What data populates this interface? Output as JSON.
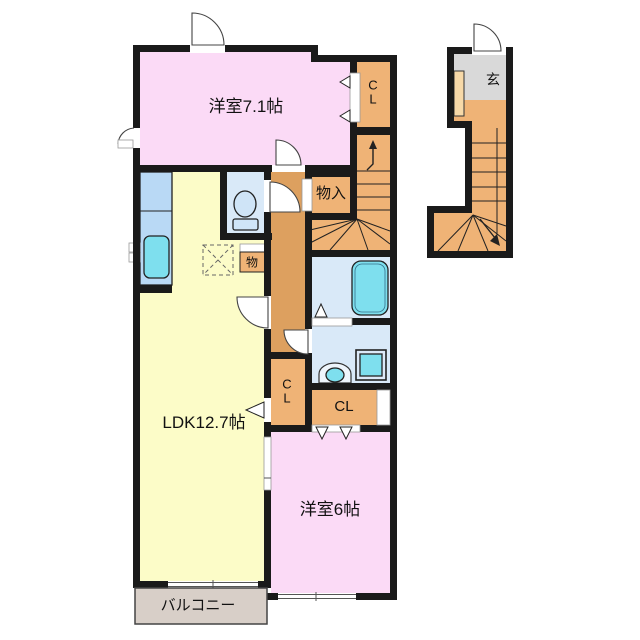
{
  "palette": {
    "wall": "#1a1a1a",
    "room_pink": "#fbdaf6",
    "room_yellow": "#fcfcc8",
    "closet_orange": "#efb376",
    "hall_orange": "#dda05f",
    "water_blue": "#d9e9f8",
    "counter_blue": "#b9d9f5",
    "fixture_cyan": "#7edfee",
    "genkan_gray": "#d9d9d9",
    "balcony_gray": "#d8cfc8",
    "shoe_cream": "#f7d9a8"
  },
  "labels": {
    "room71": "洋室7.1帖",
    "cl_top": "C\nL",
    "monoire": "物入",
    "mono": "物",
    "ldk": "LDK12.7帖",
    "cl_mid_vertical": "C\nL",
    "cl_mid": "CL",
    "room6": "洋室6帖",
    "balcony": "バルコニー",
    "genkan": "玄"
  }
}
